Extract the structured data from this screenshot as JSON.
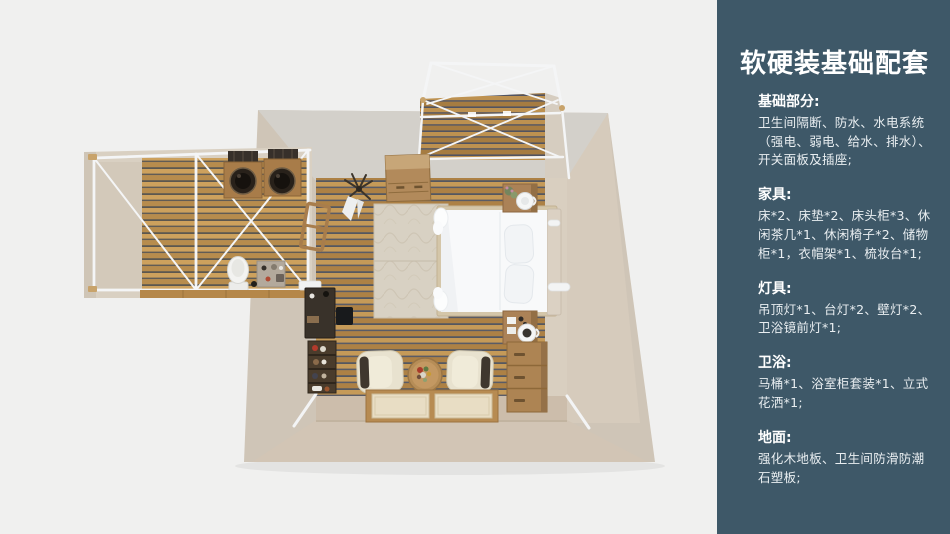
{
  "colors": {
    "page_bg": "#f0f0ef",
    "panel_bg": "#3e5868",
    "panel_text": "#ffffff",
    "wood_floor": "#bd9150",
    "wall_beige": "#d3cabb",
    "truss_white": "#f4f5f6",
    "bed_white": "#f8f9fa"
  },
  "panel": {
    "title": "软硬装基础配套",
    "sections": [
      {
        "heading": "基础部分:",
        "body": "卫生间隔断、防水、水电系统（强电、弱电、给水、排水）、开关面板及插座;"
      },
      {
        "heading": "家具:",
        "body": "床*2、床垫*2、床头柜*3、休闲茶几*1、休闲椅子*2、储物柜*1，衣帽架*1、梳妆台*1;"
      },
      {
        "heading": "灯具:",
        "body": "吊顶灯*1、台灯*2、壁灯*2、卫浴镜前灯*1;"
      },
      {
        "heading": "卫浴:",
        "body": "马桶*1、浴室柜套装*1、立式花洒*1;"
      },
      {
        "heading": "地面:",
        "body": "强化木地板、卫生间防滑防潮石塑板;"
      }
    ]
  },
  "floorplan": {
    "alt": "卧室户型俯视3D渲染图：中央卧室（床、床头柜、休闲椅*2、茶几、储物柜、梳妆台、地毯）、左侧卫生间（双盆、马桶）、上方露台白色框架"
  }
}
